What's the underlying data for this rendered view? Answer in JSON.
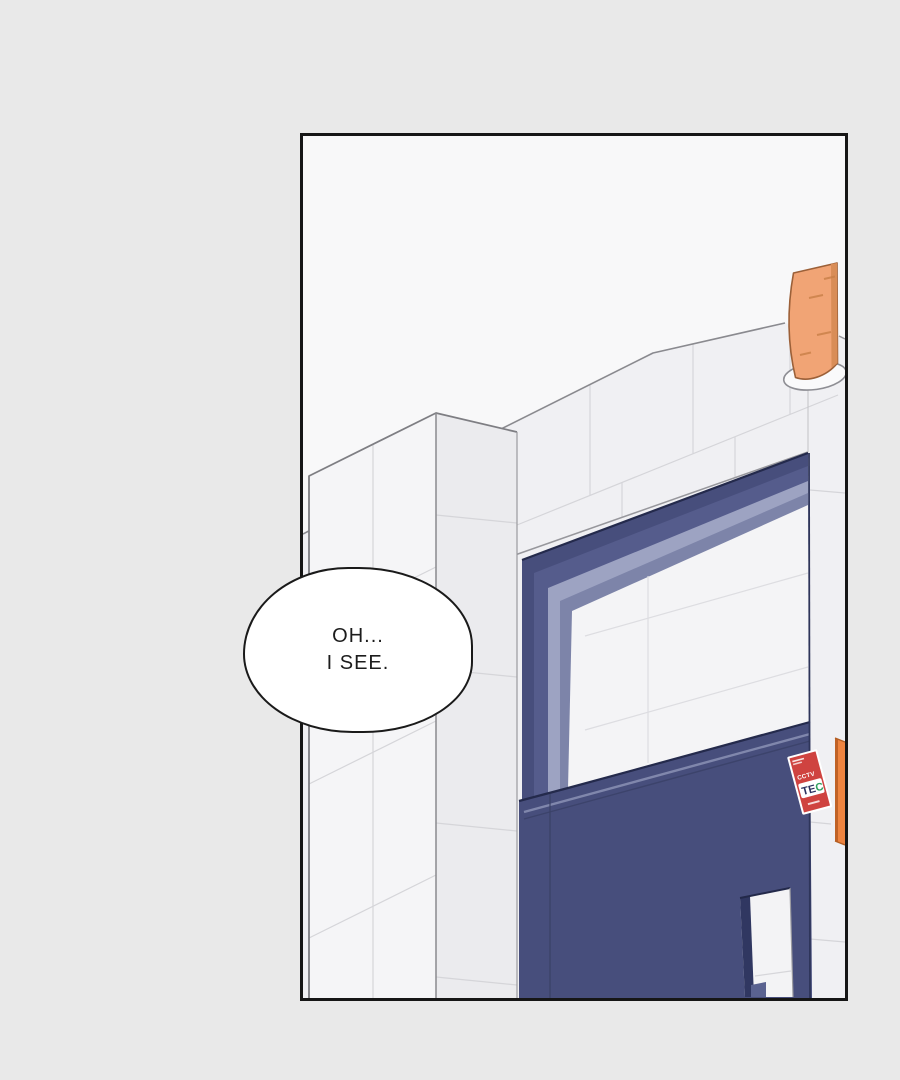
{
  "page": {
    "background": "#e9e9e9"
  },
  "panel": {
    "border_color": "#161616",
    "sky_color": "#f8f8f9"
  },
  "speech_bubble": {
    "lines": [
      "OH...",
      "I SEE."
    ]
  },
  "scene": {
    "colors": {
      "wall": "#f0f0f3",
      "column_front": "#f5f5f7",
      "column_side": "#ebebee",
      "tile_line": "#d5d5d9",
      "navy": "#474e7c",
      "navy_dark": "#2e355a",
      "frame_mid": "#555c8c",
      "frame_reveal_light": "#9da3c2",
      "frame_reveal_mid": "#7d84a9",
      "glass": "#f4f4f6",
      "lamp_orange": "#f1a475",
      "lamp_orange_dark": "#d98d57",
      "sign_orange": "#ee8440",
      "sticker_red": "#cf4340",
      "sticker_green": "#2ea05e"
    },
    "sticker": {
      "small_text": "CCTV",
      "large_text_prefix": "TE",
      "large_text_suffix": "C"
    }
  }
}
